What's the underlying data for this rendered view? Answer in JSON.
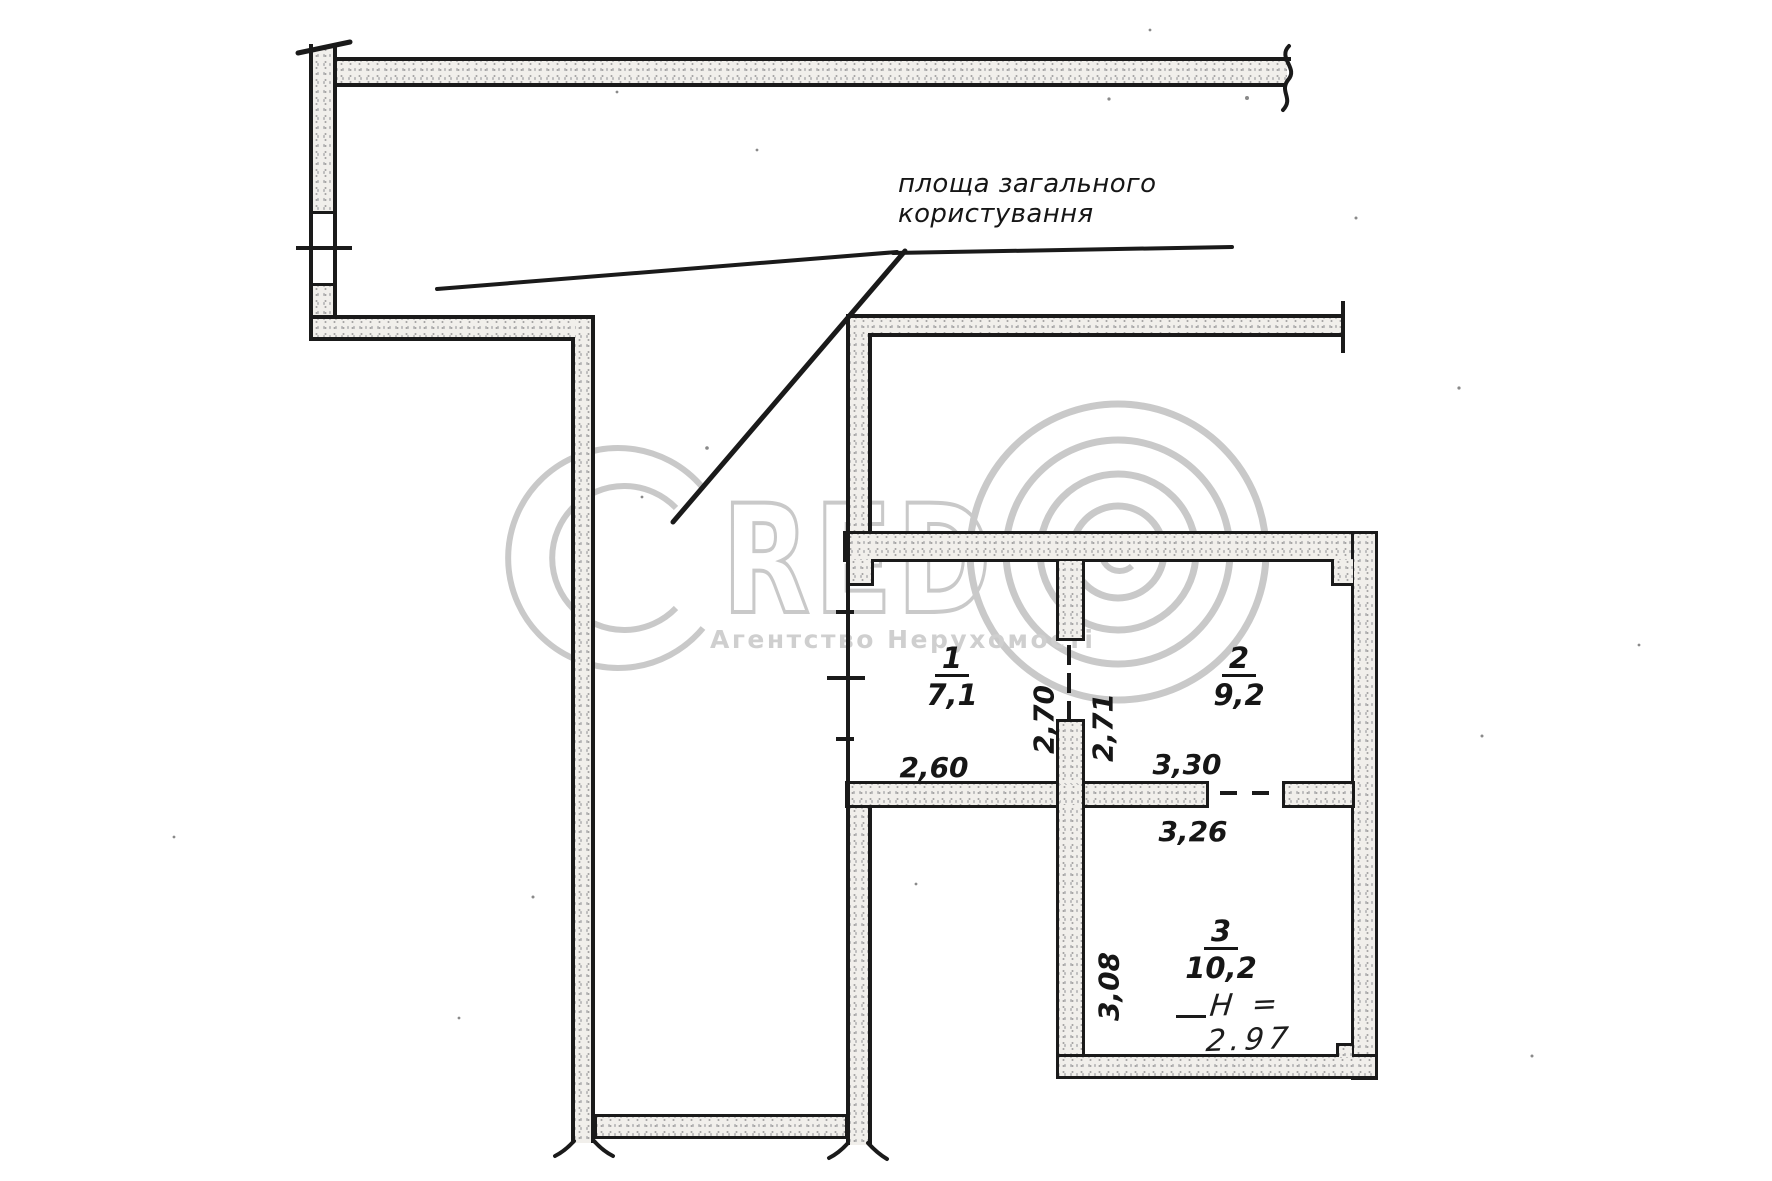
{
  "plan": {
    "common_area_label": "площа загального користування",
    "rooms": [
      {
        "number": "1",
        "area": "7,1"
      },
      {
        "number": "2",
        "area": "9,2"
      },
      {
        "number": "3",
        "area": "10,2"
      }
    ],
    "dimensions": {
      "room1_width": "2,60",
      "door_left": "2,70",
      "door_right": "2,71",
      "room2_width": "3,30",
      "room3_width": "3,26",
      "room3_depth": "3,08"
    },
    "height_note": "Н = 2.97"
  },
  "watermark": {
    "brand_letters": "RED",
    "subtitle": "Агентство Нерухомості"
  }
}
